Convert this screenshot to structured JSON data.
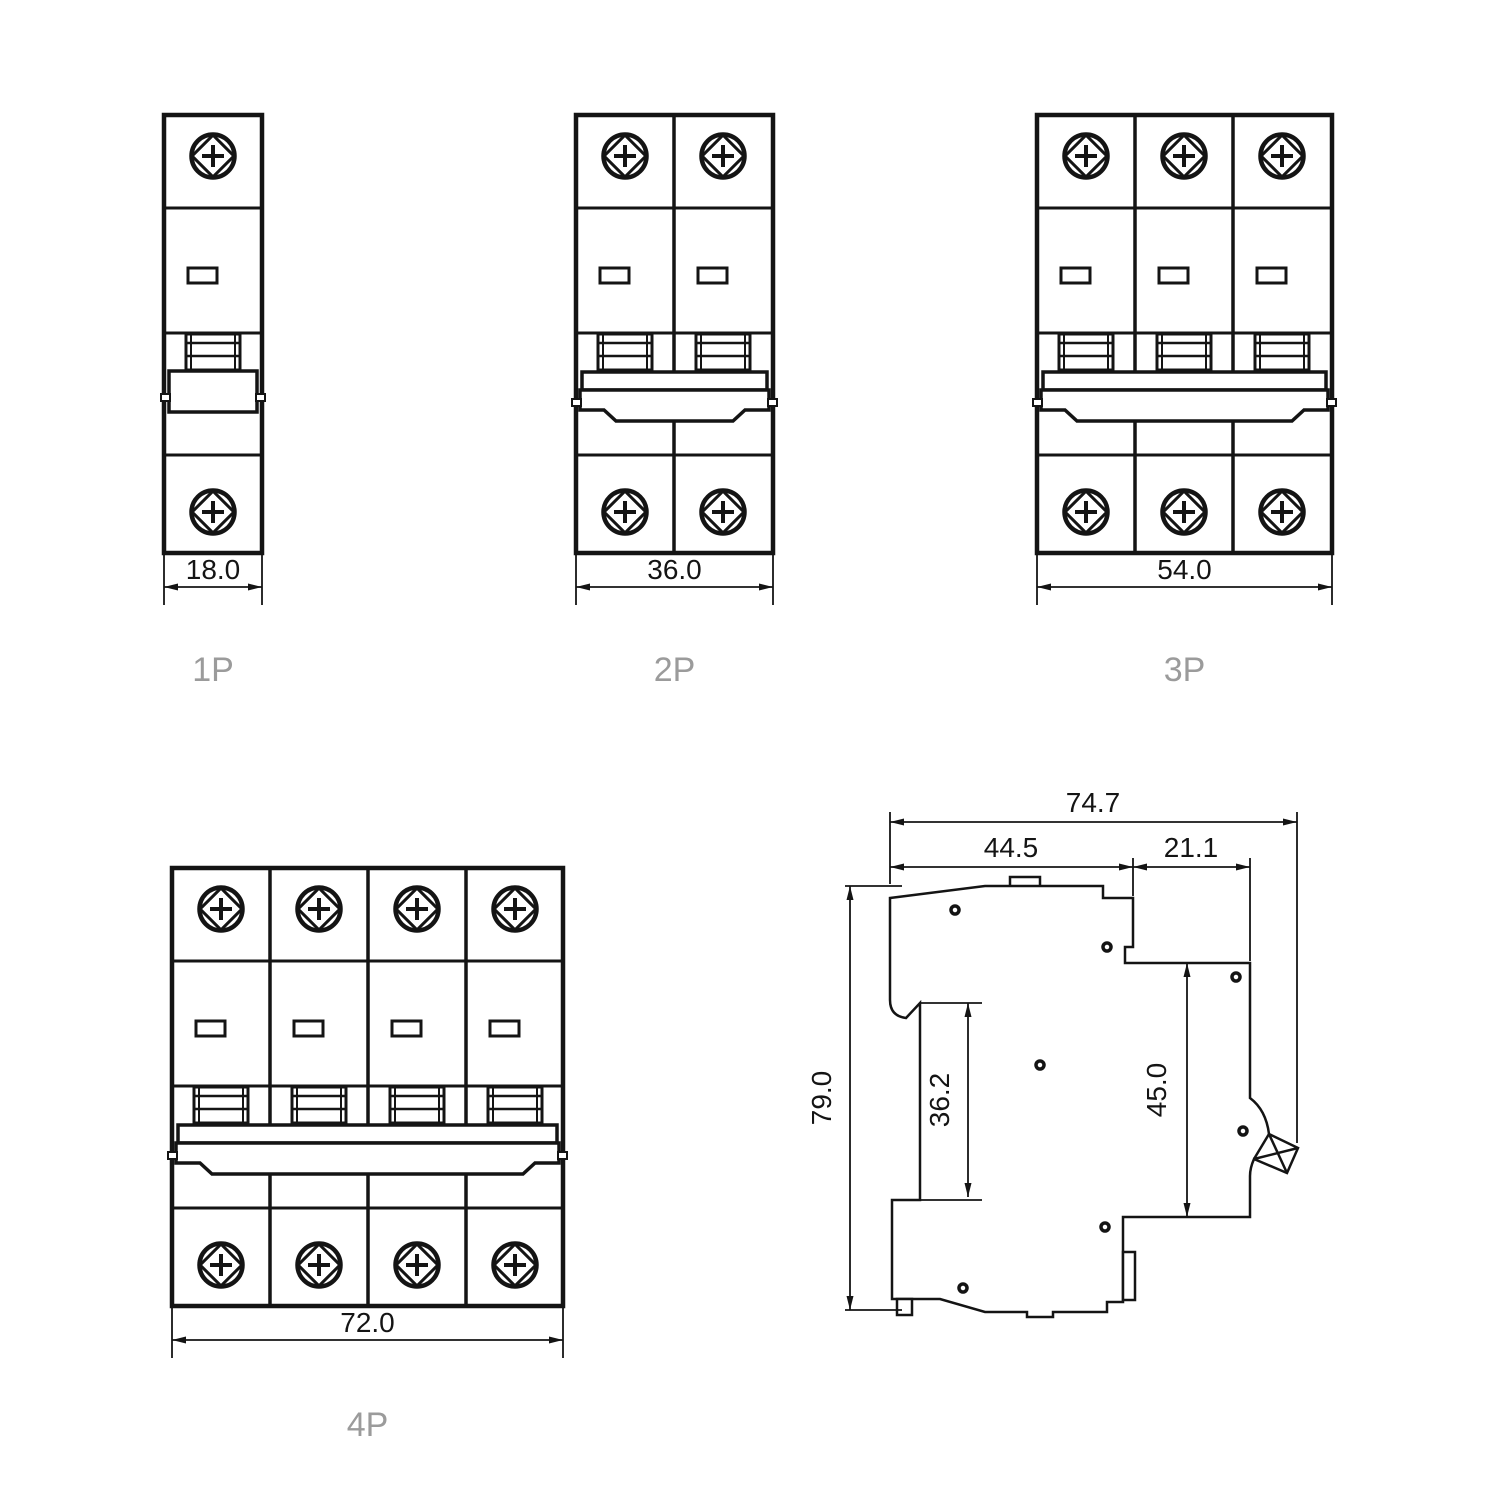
{
  "drawing_type": "circuit-breaker dimensional drawing",
  "views": {
    "p1": {
      "label": "1P",
      "width": "18.0"
    },
    "p2": {
      "label": "2P",
      "width": "36.0"
    },
    "p3": {
      "label": "3P",
      "width": "54.0"
    },
    "p4": {
      "label": "4P",
      "width": "72.0"
    }
  },
  "side": {
    "overall_width": "74.7",
    "upper_width": "44.5",
    "front_width": "21.1",
    "height": "79.0",
    "rail_recess_height": "36.2",
    "front_height": "45.0"
  },
  "colors": {
    "line": "#141414",
    "pole_label": "#9b9b9b",
    "background": "#ffffff"
  }
}
